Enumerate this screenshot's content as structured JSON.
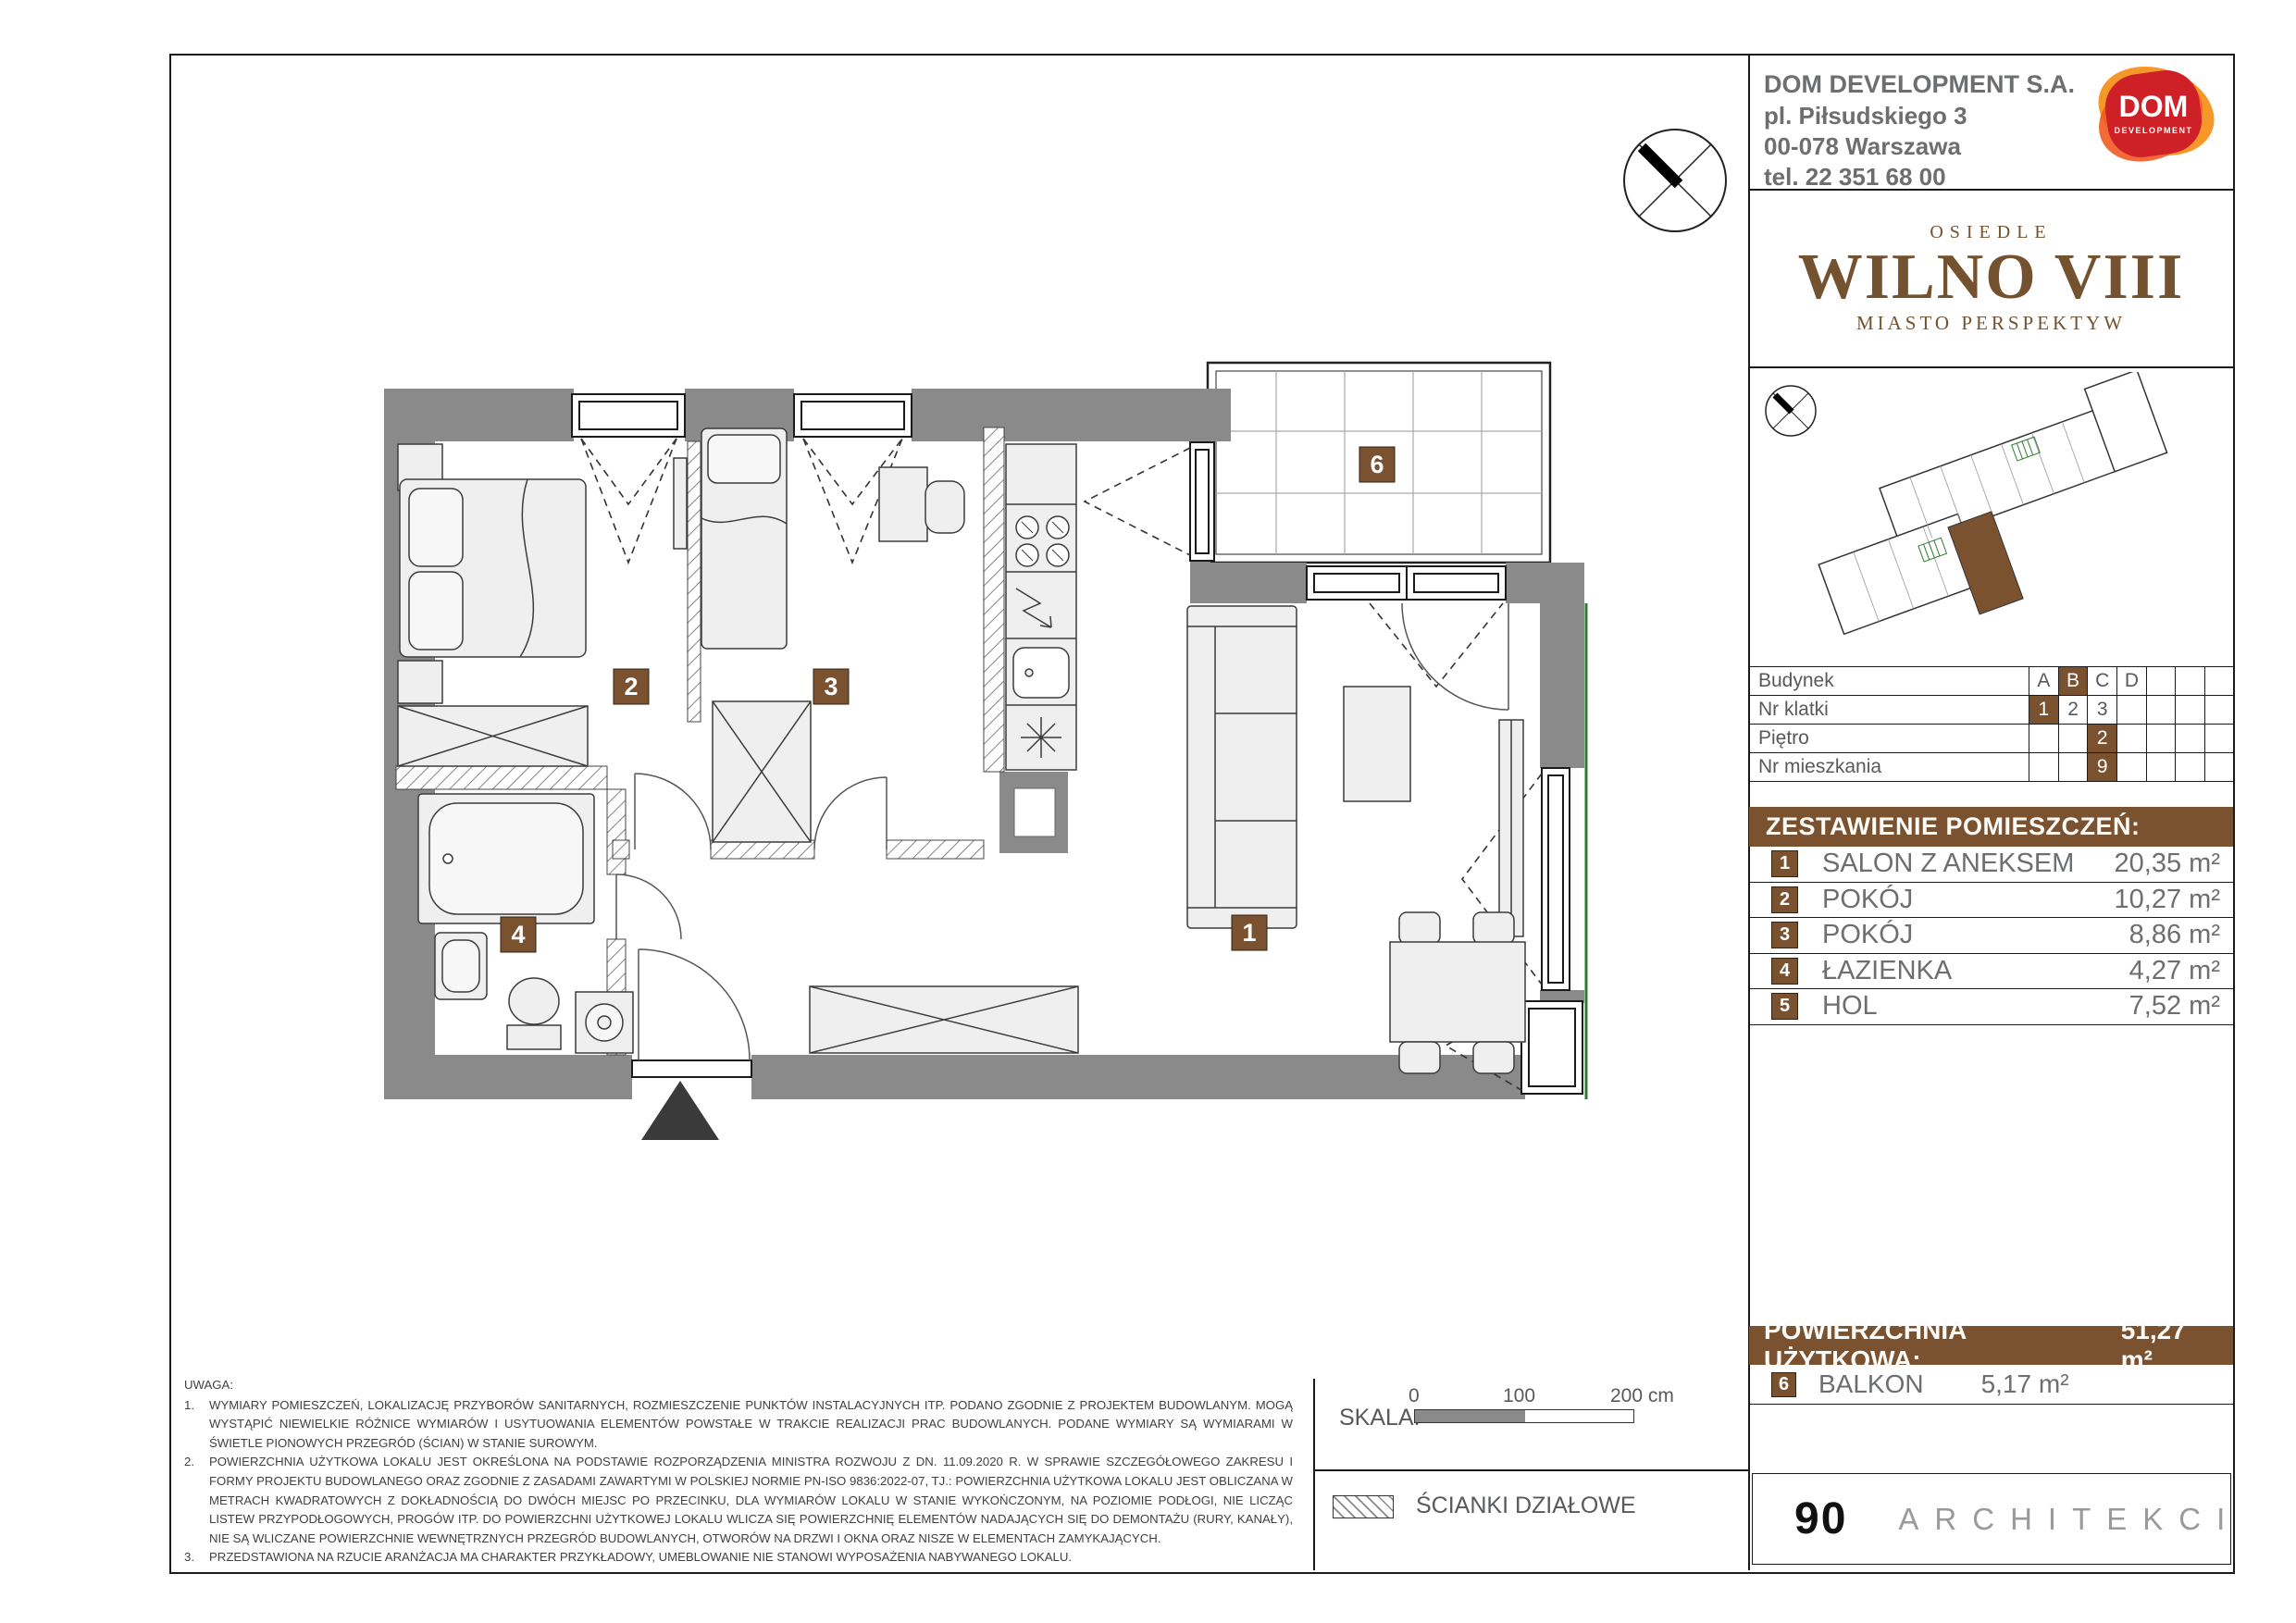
{
  "header": {
    "company": "DOM DEVELOPMENT S.A.",
    "address_line1": "pl. Piłsudskiego 3",
    "address_line2": "00-078 Warszawa",
    "phone": "tel. 22 351 68 00",
    "logo_text": "DOM",
    "logo_subtext": "DEVELOPMENT"
  },
  "project": {
    "over": "OSIEDLE",
    "name": "WILNO VIII",
    "tagline": "MIASTO PERSPEKTYW"
  },
  "info_table": {
    "rows": [
      {
        "label": "Budynek",
        "cells": [
          "A",
          "B",
          "C",
          "D",
          "",
          "",
          ""
        ],
        "highlight": 1
      },
      {
        "label": "Nr klatki",
        "cells": [
          "1",
          "2",
          "3",
          "",
          "",
          "",
          ""
        ],
        "highlight": 0
      },
      {
        "label": "Piętro",
        "cells": [
          "",
          "",
          "2",
          "",
          "",
          "",
          ""
        ],
        "highlight": 2
      },
      {
        "label": "Nr mieszkania",
        "cells": [
          "",
          "",
          "9",
          "",
          "",
          "",
          ""
        ],
        "highlight": 2
      }
    ]
  },
  "rooms": {
    "title": "ZESTAWIENIE POMIESZCZEŃ:",
    "items": [
      {
        "no": "1",
        "name": "SALON Z ANEKSEM",
        "area": "20,35 m²"
      },
      {
        "no": "2",
        "name": "POKÓJ",
        "area": "10,27 m²"
      },
      {
        "no": "3",
        "name": "POKÓJ",
        "area": "8,86 m²"
      },
      {
        "no": "4",
        "name": "ŁAZIENKA",
        "area": "4,27 m²"
      },
      {
        "no": "5",
        "name": "HOL",
        "area": "7,52 m²"
      }
    ]
  },
  "totals": {
    "usable_label": "POWIERZCHNIA UŻYTKOWA:",
    "usable_value": "51,27 m²",
    "balcony_no": "6",
    "balcony_label": "BALKON",
    "balcony_value": "5,17 m²"
  },
  "plan": {
    "badges": {
      "salon": "1",
      "room2": "2",
      "room3": "3",
      "bathroom": "4",
      "balcony": "6"
    }
  },
  "notes": {
    "heading": "UWAGA:",
    "items": [
      "WYMIARY POMIESZCZEŃ, LOKALIZACJĘ PRZYBORÓW SANITARNYCH, ROZMIESZCZENIE PUNKTÓW INSTALACYJNYCH ITP. PODANO ZGODNIE Z PROJEKTEM BUDOWLANYM. MOGĄ WYSTĄPIĆ NIEWIELKIE RÓŻNICE WYMIARÓW I USYTUOWANIA ELEMENTÓW POWSTAŁE W TRAKCIE REALIZACJI PRAC BUDOWLANYCH. PODANE WYMIARY SĄ WYMIARAMI W ŚWIETLE PIONOWYCH PRZEGRÓD (ŚCIAN) W STANIE SUROWYM.",
      "POWIERZCHNIA UŻYTKOWA LOKALU JEST OKREŚLONA NA PODSTAWIE ROZPORZĄDZENIA MINISTRA ROZWOJU Z DN. 11.09.2020 R. W SPRAWIE SZCZEGÓŁOWEGO ZAKRESU I FORMY PROJEKTU BUDOWLANEGO ORAZ ZGODNIE Z ZASADAMI ZAWARTYMI W POLSKIEJ NORMIE PN-ISO 9836:2022-07, TJ.: POWIERZCHNIA UŻYTKOWA LOKALU JEST OBLICZANA W METRACH KWADRATOWYCH Z DOKŁADNOŚCIĄ DO DWÓCH MIEJSC PO PRZECINKU, DLA WYMIARÓW LOKALU W STANIE WYKOŃCZONYM, NA POZIOMIE PODŁOGI, NIE LICZĄC LISTEW PRZYPODŁOGOWYCH, PROGÓW ITP. DO POWIERZCHNI UŻYTKOWEJ LOKALU WLICZA SIĘ POWIERZCHNIĘ ELEMENTÓW NADAJĄCYCH SIĘ DO DEMONTAŻU (RURY, KANAŁY), NIE SĄ WLICZANE POWIERZCHNIE WEWNĘTRZNYCH PRZEGRÓD BUDOWLANYCH, OTWORÓW NA DRZWI I OKNA ORAZ NISZE W ELEMENTACH ZAMYKAJĄCYCH.",
      "PRZEDSTAWIONA NA RZUCIE ARANŻACJA MA CHARAKTER PRZYKŁADOWY, UMEBLOWANIE NIE STANOWI WYPOSAŻENIA NABYWANEGO LOKALU."
    ]
  },
  "scale": {
    "label": "SKALA:",
    "tick0": "0",
    "tick100": "100",
    "tick200": "200 cm"
  },
  "legend": {
    "partition_label": "ŚCIANKI DZIAŁOWE"
  },
  "architects": {
    "number": "90",
    "name": "ARCHITEKCI"
  },
  "colors": {
    "brown": "#7a5230",
    "wall_gray": "#8a8a8a",
    "furniture_fill": "#efefef",
    "logo_red": "#ce2127",
    "logo_orange": "#f6921e",
    "logo_orange2": "#f05a22",
    "wilno_brown": "#74512f",
    "green_boundary": "#2e7d32"
  }
}
